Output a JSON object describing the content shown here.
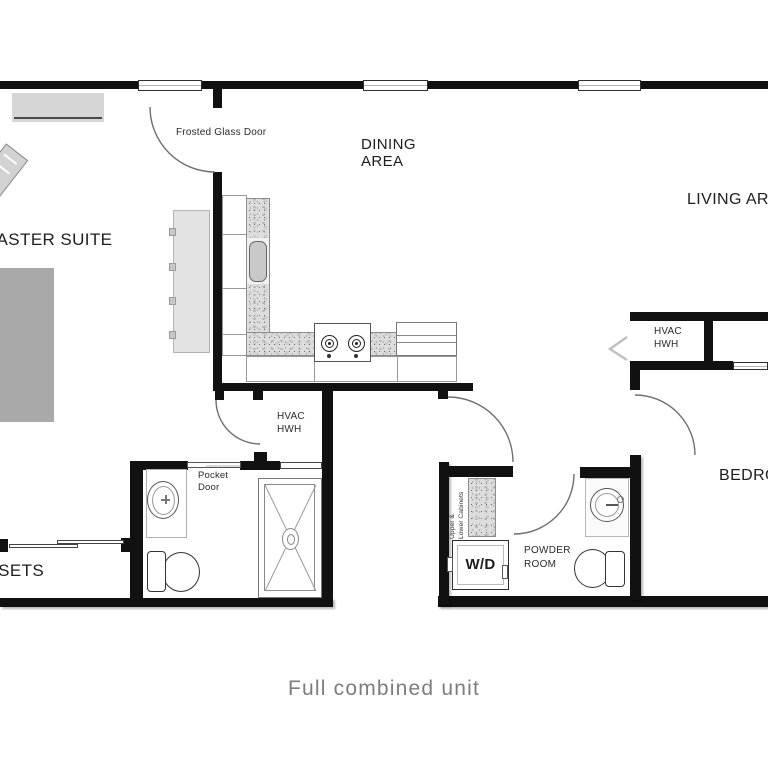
{
  "plan": {
    "caption": "Full combined unit",
    "labels": {
      "master_suite": "MASTER SUITE",
      "closets": "CLOSETS",
      "dining_area": "DINING\nAREA",
      "living_area": "LIVING AREA",
      "bedroom": "BEDROOM",
      "frosted_glass_door": "Frosted Glass Door",
      "pocket_door": "Pocket\nDoor",
      "hvac_hall": "HVAC\nHWH",
      "hvac_living": "HVAC\nHWH",
      "powder_room": "POWDER\nROOM",
      "washer_dryer": "W/D",
      "upper_lower_cabinets": "Upper &\nLower Cabinets"
    },
    "colors": {
      "wall": "#111111",
      "arc": "#6f6f6f",
      "bed": "#a9a9a9",
      "dresser": "#d6d6d6",
      "island": "#e3e3e3",
      "label": "#1d1d1d",
      "caption": "#7d7d7d"
    }
  }
}
